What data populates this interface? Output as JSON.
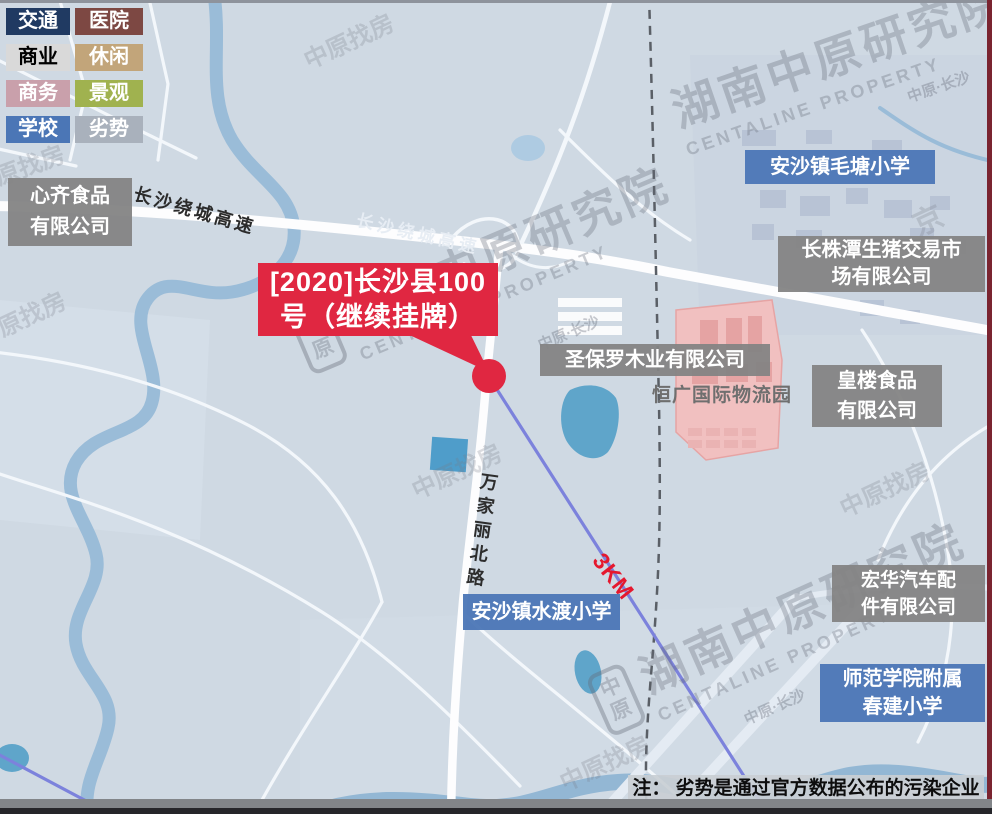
{
  "legend": {
    "items": [
      {
        "label": "交通",
        "color": "#203a62",
        "text": "#ffffff"
      },
      {
        "label": "医院",
        "color": "#7d4843",
        "text": "#ffffff"
      },
      {
        "label": "商业",
        "color": "#d9d9d9",
        "text": "#000000"
      },
      {
        "label": "休闲",
        "color": "#c2a57a",
        "text": "#ffffff"
      },
      {
        "label": "商务",
        "color": "#c9a0ab",
        "text": "#ffffff"
      },
      {
        "label": "景观",
        "color": "#a0b24f",
        "text": "#ffffff"
      },
      {
        "label": "学校",
        "color": "#4b76b6",
        "text": "#ffffff"
      },
      {
        "label": "劣势",
        "color": "#a9b1bc",
        "text": "#ffffff"
      }
    ]
  },
  "callout": {
    "line1": "[2020]长沙县100",
    "line2": "号（继续挂牌）"
  },
  "places": {
    "xinqi_l1": "心齐食品",
    "xinqi_l2": "有限公司",
    "maotang": "安沙镇毛塘小学",
    "pig_l1": "长株潭生猪交易市",
    "pig_l2": "场有限公司",
    "stpaul": "圣保罗木业有限公司",
    "hengguang": "恒广国际物流园",
    "huanglou_l1": "皇楼食品",
    "huanglou_l2": "有限公司",
    "shuidu": "安沙镇水渡小学",
    "honghua_l1": "宏华汽车配",
    "honghua_l2": "件有限公司",
    "shifan_l1": "师范学院附属",
    "shifan_l2": "春建小学"
  },
  "roads": {
    "ring": "长沙绕城高速",
    "wanjiali": "万家丽北路"
  },
  "distance_label": "3KM",
  "note": "注： 劣势是通过官方数据公布的污染企业",
  "watermark": {
    "cn": "湖南中原研究院",
    "en": "CENTALINE PROPERTY",
    "sub": "中原·长沙",
    "logo_top": "中",
    "logo_bottom": "原",
    "small": "中原找房",
    "small2": "京"
  },
  "colors": {
    "map_bg": "#cfd9e3",
    "water": "#9abcd8",
    "lake": "#5fa5ca",
    "road": "#ffffff",
    "railway": "#5a5f66",
    "distance_line": "#7c82dc",
    "park_fill": "#f1c0c0",
    "label_gray": "#868686",
    "school_blue": "#4b76b6",
    "accent_red": "#e02741",
    "note_bg": "#c9ced4"
  }
}
